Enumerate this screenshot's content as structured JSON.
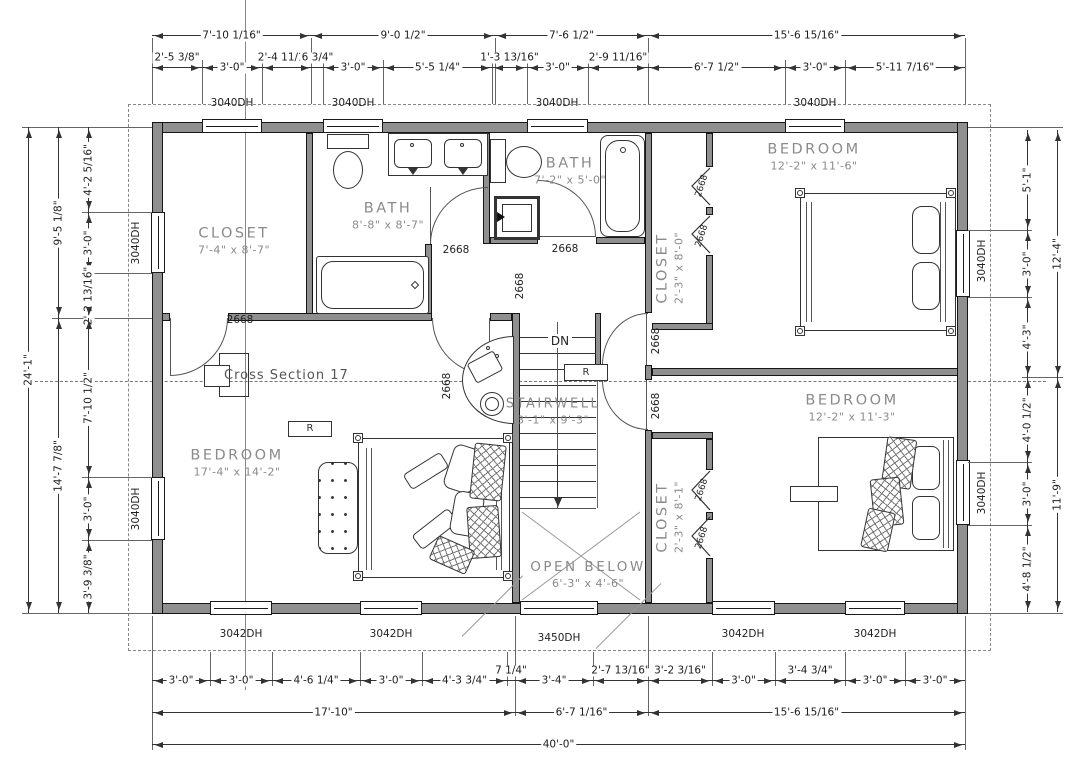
{
  "rooms": {
    "closet_tl": {
      "name": "CLOSET",
      "dims": "7'-4\" x 8'-7\""
    },
    "bath_main": {
      "name": "BATH",
      "dims": "8'-8\" x 8'-7\""
    },
    "bath_small": {
      "name": "BATH",
      "dims": "7'-2\" x 5'-0\""
    },
    "bedroom_tr": {
      "name": "BEDROOM",
      "dims": "12'-2\" x 11'-6\""
    },
    "closet_tr": {
      "name": "CLOSET",
      "dims": "2'-3\" x 8'-0\""
    },
    "bedroom_l": {
      "name": "BEDROOM",
      "dims": "17'-4\" x 14'-2\""
    },
    "stairwell": {
      "name": "STAIRWELL",
      "dims": "3'-1\" x 9'-3\""
    },
    "open_below": {
      "name": "OPEN BELOW",
      "dims": "6'-3\" x 4'-6\""
    },
    "closet_br": {
      "name": "CLOSET",
      "dims": "2'-3\" x 8'-1\""
    },
    "bedroom_br": {
      "name": "BEDROOM",
      "dims": "12'-2\" x 11'-3\""
    }
  },
  "annotations": {
    "cross_section": "Cross Section 17",
    "stairs_down": "DN",
    "register": "R"
  },
  "windows": {
    "w3040": "3040DH",
    "w3042": "3042DH",
    "w3450": "3450DH"
  },
  "doors": {
    "d2668": "2668"
  },
  "dims": {
    "top_row1": [
      "7'-10 1/16\"",
      "9'-0 1/2\"",
      "7'-6 1/2\"",
      "15'-6 15/16\""
    ],
    "top_row2": [
      "2'-5 3/8\"",
      "3'-0\"",
      "2'-4 11/16\"",
      "6 3/4\"",
      "3'-0\"",
      "5'-5 1/4\"",
      "1'-3 13/16\"",
      "3'-0\"",
      "2'-9 11/16\"",
      "6'-7 1/2\"",
      "3'-0\"",
      "5'-11 7/16\""
    ],
    "bottom_row1": [
      "3'-0\"",
      "3'-0\"",
      "4'-6 1/4\"",
      "3'-0\"",
      "4'-3 3/4\"",
      "7 1/4\"",
      "3'-4\"",
      "2'-7 13/16\"",
      "3'-2 3/16\"",
      "3'-0\"",
      "3'-4 3/4\"",
      "3'-0\"",
      "3'-0\""
    ],
    "bottom_row2": [
      "17'-10\"",
      "6'-7 1/16\"",
      "15'-6 15/16\""
    ],
    "bottom_row3": [
      "40'-0\""
    ],
    "left_outer": [
      "24'-1\""
    ],
    "left_mid": [
      "9'-5 1/8\"",
      "14'-7 7/8\""
    ],
    "left_inner": [
      "4'-2 5/16\"",
      "3'-0\"",
      "2'-2 13/16\"",
      "7'-10 1/2\"",
      "3'-0\"",
      "3'-9 3/8\""
    ],
    "right_inner": [
      "5'-1\"",
      "3'-0\"",
      "4'-3\"",
      "4'-0 1/2\"",
      "3'-0\"",
      "4'-8 1/2\""
    ],
    "right_outer": [
      "12'-4\"",
      "11'-9\""
    ]
  }
}
